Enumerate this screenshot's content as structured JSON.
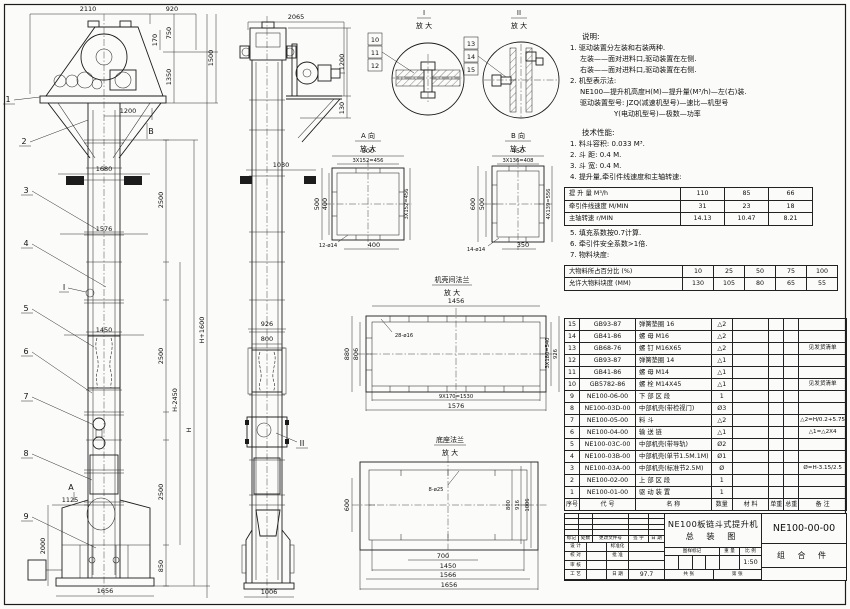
{
  "dims": {
    "d2110": "2110",
    "d920": "920",
    "d170": "170",
    "d750": "750",
    "d1350": "1350",
    "d1500": "1500",
    "d1200": "1200",
    "d1680": "1680",
    "d2500": "2500",
    "d1576": "1576",
    "d1450": "1450",
    "d1125": "1125",
    "d2000": "2000",
    "d850": "850",
    "d1656": "1656",
    "dH1600": "H+1600",
    "dH2450": "H-2450",
    "dH": "H",
    "d2065": "2065",
    "d130": "130",
    "d1030": "1030",
    "d926": "926",
    "d800": "800",
    "d1006": "1006",
    "d500": "500",
    "d400": "400",
    "sA": "3X152=456",
    "hA": "12-ø14",
    "d450": "450",
    "d600": "600",
    "d350": "350",
    "sB": "3X136=408",
    "sB2": "4X139=556",
    "hB": "14-ø14",
    "d1456": "1456",
    "h28": "28-ø16",
    "d880": "880",
    "d806": "806",
    "s540": "3X180=540",
    "s1530": "9X170=1530",
    "h8": "8-ø25",
    "d700": "700",
    "d916": "916",
    "d1566": "1566"
  },
  "balloons": [
    "1",
    "2",
    "3",
    "4",
    "5",
    "6",
    "7",
    "8",
    "9",
    "10",
    "11",
    "12",
    "13",
    "14",
    "15"
  ],
  "markers": {
    "a": "A",
    "b": "B",
    "i": "I",
    "ii": "II",
    "dir_a": "A 向",
    "dir_b": "B 向",
    "enlarge": "放 大",
    "flange_top": "机壳间法兰",
    "flange_base": "底座法兰"
  },
  "notes": {
    "title": "说明:",
    "lines": [
      "1. 驱动装置分左装和右装两种.",
      "左装——面对进料口,驱动装置在左侧.",
      "右装——面对进料口,驱动装置在右侧.",
      "2. 机型表示法:",
      "NE100—提升机高度H(M)—提升量(M³/h)—左(右)装.",
      "驱动装置型号: JZQ(减速机型号)—速比—机型号",
      "Y(电动机型号)—极数—功率"
    ]
  },
  "tech": {
    "title": "技术性能:",
    "lines1": [
      "1. 料斗容积: 0.033 M³.",
      "2. 斗    距: 0.4 M.",
      "3. 斗    宽: 0.4 M.",
      "4. 提升量,牵引件线速度和主轴转速:"
    ],
    "lines2": [
      "5. 填充系数按0.7计算.",
      "6. 牵引件安全系数>1倍.",
      "7. 物料块度:"
    ]
  },
  "perf_table": {
    "rows": [
      {
        "label": "提 升 量    M³/h",
        "values": [
          "110",
          "85",
          "66"
        ]
      },
      {
        "label": "牵引件线速度  M/MIN",
        "values": [
          "31",
          "23",
          "18"
        ]
      },
      {
        "label": "主轴转速    r/MIN",
        "values": [
          "14.13",
          "10.47",
          "8.21"
        ]
      }
    ]
  },
  "size_table": {
    "rows": [
      {
        "label": "大物料所占百分比 (%)",
        "values": [
          "10",
          "25",
          "50",
          "75",
          "100"
        ]
      },
      {
        "label": "允许大物料块度 (MM)",
        "values": [
          "130",
          "105",
          "80",
          "65",
          "55"
        ]
      }
    ]
  },
  "bom": {
    "headers": [
      "序号",
      "代  号",
      "名  称",
      "数量",
      "材  料",
      "单重",
      "总重",
      "备  注"
    ],
    "rows": [
      {
        "seq": "15",
        "code": "GB93-87",
        "name": "弹簧垫圈 16",
        "qty": "△2",
        "remark": ""
      },
      {
        "seq": "14",
        "code": "GB41-86",
        "name": "螺 母 M16",
        "qty": "△2",
        "remark": ""
      },
      {
        "seq": "13",
        "code": "GB68-76",
        "name": "螺 钉 M16X65",
        "qty": "△2",
        "remark": "见发货清单"
      },
      {
        "seq": "12",
        "code": "GB93-87",
        "name": "弹簧垫圈 14",
        "qty": "△1",
        "remark": ""
      },
      {
        "seq": "11",
        "code": "GB41-86",
        "name": "螺 母 M14",
        "qty": "△1",
        "remark": ""
      },
      {
        "seq": "10",
        "code": "GB5782-86",
        "name": "螺 栓 M14X45",
        "qty": "△1",
        "remark": "见发货清单"
      },
      {
        "seq": "9",
        "code": "NE100-06-00",
        "name": "下 部 区 段",
        "qty": "1",
        "remark": ""
      },
      {
        "seq": "8",
        "code": "NE100-03D-00",
        "name": "中部机壳(带检视门)",
        "qty": "Ø3",
        "remark": ""
      },
      {
        "seq": "7",
        "code": "NE100-05-00",
        "name": "料  斗",
        "qty": "△2",
        "remark": "△2=H/0.2+5.75"
      },
      {
        "seq": "6",
        "code": "NE100-04-00",
        "name": "输 送 链",
        "qty": "△1",
        "remark": "△1=△2X4"
      },
      {
        "seq": "5",
        "code": "NE100-03C-00",
        "name": "中部机壳(带导轨)",
        "qty": "Ø2",
        "remark": ""
      },
      {
        "seq": "4",
        "code": "NE100-03B-00",
        "name": "中部机壳(单节1.5M.1M)",
        "qty": "Ø1",
        "remark": ""
      },
      {
        "seq": "3",
        "code": "NE100-03A-00",
        "name": "中部机壳(标准节2.5M)",
        "qty": "Ø",
        "remark": "Ø=H-3.15/2.5"
      },
      {
        "seq": "2",
        "code": "NE100-02-00",
        "name": "上 部 区 段",
        "qty": "1",
        "remark": ""
      },
      {
        "seq": "1",
        "code": "NE100-01-00",
        "name": "驱 动 装 置",
        "qty": "1",
        "remark": ""
      }
    ]
  },
  "titleblock": {
    "title_line1": "NE100板链斗式提升机",
    "title_line2": "总 装 图",
    "drawing_no": "NE100-00-00",
    "part_type": "组 合 件",
    "scale_value": "1:50",
    "date_value": "97.7",
    "rev_labels": [
      "标记",
      "处数",
      "更改文件号",
      "签 字",
      "日 期"
    ],
    "sig_rows": [
      [
        "设 计",
        "标准化"
      ],
      [
        "校 对",
        "批 准"
      ],
      [
        "审 核",
        ""
      ],
      [
        "工 艺",
        "日 期"
      ]
    ],
    "stamp_label": "图样标记",
    "weight_label": "重 量",
    "scale_label": "比 例",
    "sheets_label": "共  张",
    "sheet_no_label": "第  张"
  }
}
